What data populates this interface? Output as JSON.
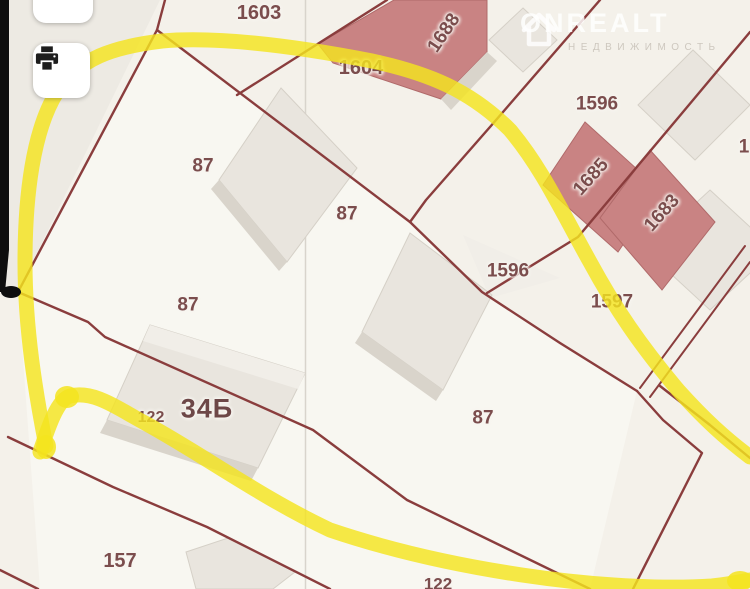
{
  "toolbar": {
    "buttons": [
      {
        "id": "back",
        "icon": "arrow-down-left-icon"
      },
      {
        "id": "print",
        "icon": "printer-icon"
      }
    ]
  },
  "watermark": {
    "brand": "ONREALT",
    "subtitle": "НЕДВИЖИМОСТЬ",
    "icon": "house-icon"
  },
  "map": {
    "type": "cadastral-map",
    "annotation": "yellow-marker-strokes",
    "parcel_labels": [
      {
        "text": "1603",
        "x": 259,
        "y": 13,
        "size": 20,
        "rotate": 0
      },
      {
        "text": "1688",
        "x": 444,
        "y": 33,
        "size": 19,
        "rotate": -56
      },
      {
        "text": "1604",
        "x": 361,
        "y": 68,
        "size": 20,
        "rotate": 0
      },
      {
        "text": "1596",
        "x": 597,
        "y": 104,
        "size": 19,
        "rotate": 0
      },
      {
        "text": "1685",
        "x": 591,
        "y": 177,
        "size": 19,
        "rotate": -48
      },
      {
        "text": "87",
        "x": 203,
        "y": 166,
        "size": 19,
        "rotate": 0
      },
      {
        "text": "1683",
        "x": 662,
        "y": 213,
        "size": 19,
        "rotate": -48
      },
      {
        "text": "1",
        "x": 744,
        "y": 147,
        "size": 19,
        "rotate": 0
      },
      {
        "text": "87",
        "x": 347,
        "y": 214,
        "size": 19,
        "rotate": 0
      },
      {
        "text": "1596",
        "x": 508,
        "y": 271,
        "size": 19,
        "rotate": 0
      },
      {
        "text": "1597",
        "x": 612,
        "y": 302,
        "size": 19,
        "rotate": 0
      },
      {
        "text": "87",
        "x": 188,
        "y": 305,
        "size": 19,
        "rotate": 0
      },
      {
        "text": "34Б",
        "x": 207,
        "y": 409,
        "size": 27,
        "rotate": 0,
        "emphasis": true
      },
      {
        "text": "122",
        "x": 151,
        "y": 418,
        "size": 16,
        "rotate": 0
      },
      {
        "text": "87",
        "x": 483,
        "y": 418,
        "size": 19,
        "rotate": 0
      },
      {
        "text": "157",
        "x": 120,
        "y": 561,
        "size": 20,
        "rotate": 0
      },
      {
        "text": "122",
        "x": 438,
        "y": 584,
        "size": 17,
        "rotate": 0
      }
    ],
    "colors": {
      "background": "#f4f1ea",
      "parcel_light": "#faf8f3",
      "boundary": "#8a3d3d",
      "building_red": "#c98383",
      "building_gray": "#e9e5de",
      "building_gray_dark": "#d9d4cb",
      "grid_line": "#d8d4cc",
      "highlight": "#f4e41f",
      "label": "#7b4d4d",
      "label_dark": "#6d4747"
    }
  }
}
